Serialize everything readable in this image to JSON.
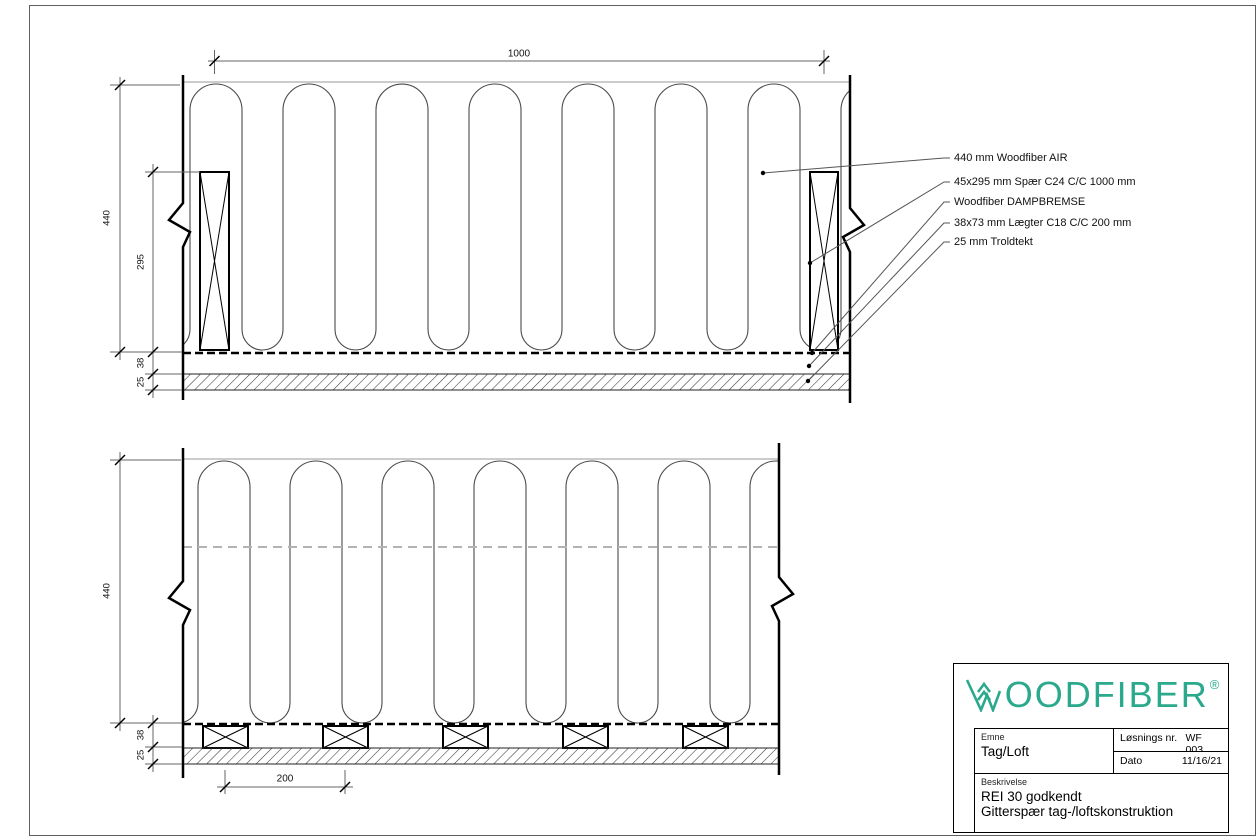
{
  "colors": {
    "brand_teal": "#2ba98c",
    "line_color": "#000000"
  },
  "drawing_top": {
    "dim_spacing_spaer": "1000",
    "dim_total_height": "440",
    "dim_spaer_height": "295",
    "dim_laegter": "38",
    "dim_troldtekt": "25"
  },
  "callouts": {
    "items": [
      {
        "label": "440 mm Woodfiber AIR"
      },
      {
        "label": "45x295 mm Spær C24 C/C 1000 mm"
      },
      {
        "label": "Woodfiber DAMPBREMSE"
      },
      {
        "label": "38x73 mm Lægter C18 C/C 200 mm"
      },
      {
        "label": "25 mm Troldtekt"
      }
    ]
  },
  "drawing_bottom": {
    "dim_total_height": "440",
    "dim_laegter": "38",
    "dim_troldtekt": "25",
    "dim_laegter_cc": "200"
  },
  "title_block": {
    "brand_name": "WOODFIBER",
    "brand_text_after_mark": "OODFIBER",
    "brand_reg_mark": "®",
    "emne_label": "Emne",
    "emne_value": "Tag/Loft",
    "solution_no_label": "Løsnings nr.",
    "solution_no_value": "WF 003",
    "date_label": "Dato",
    "date_value": "11/16/21",
    "description_label": "Beskrivelse",
    "description_line1": "REI 30 godkendt",
    "description_line2": "Gitterspær tag-/loftskonstruktion"
  }
}
